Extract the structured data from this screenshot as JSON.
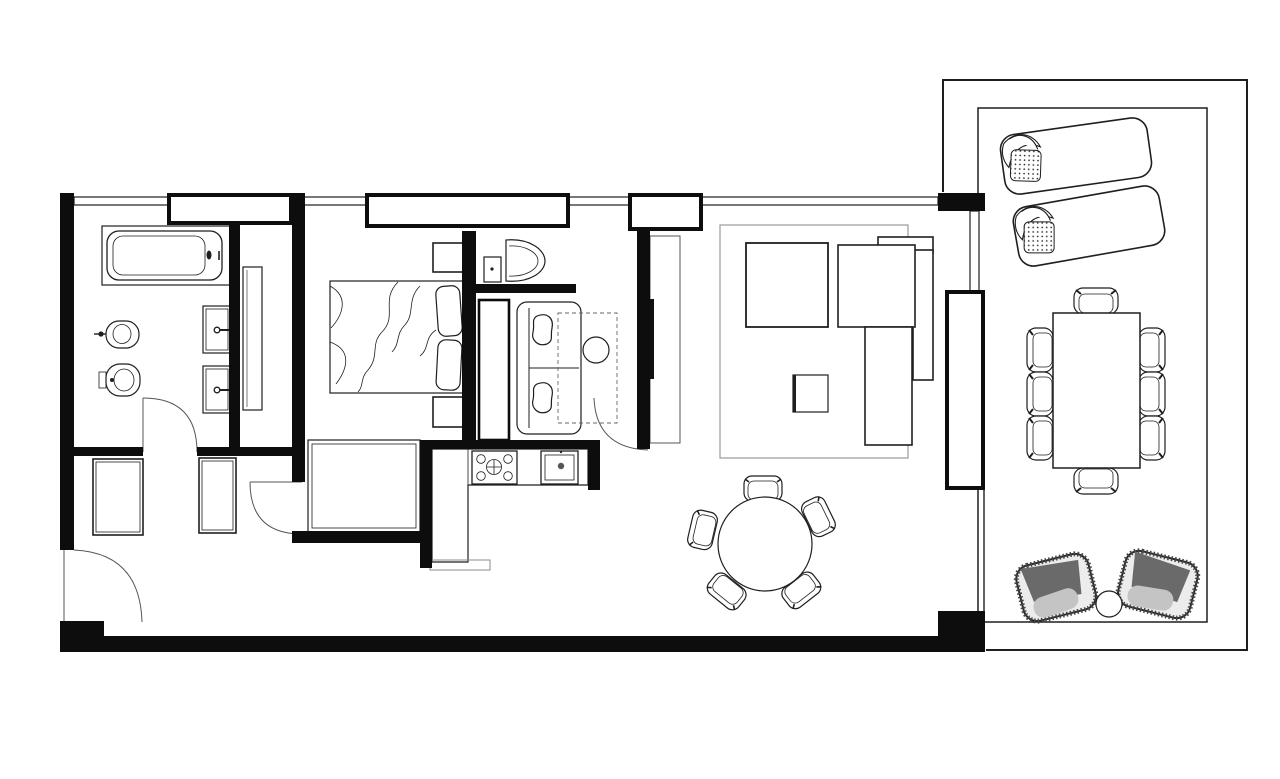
{
  "document": {
    "type": "architectural-floor-plan",
    "style": "black-and-white CAD line drawing",
    "description": "One-bedroom apartment floor plan with bathroom, entry hall, bedroom, TV nook, WC, kitchen, living-dining room and a large furnished terrace"
  },
  "colors": {
    "background": "#ffffff",
    "line": "#1f1f1f",
    "wall_fill": "#0d0d0d",
    "rug_outline": "#999999",
    "tv_fill": "#111111",
    "cabinet_outline": "#555555",
    "armchair_dark": "#6a6a6a",
    "armchair_light": "#c4c4c4"
  },
  "rooms": [
    {
      "name": "bathroom",
      "furniture": [
        "bathtub",
        "bidet",
        "toilet",
        "vanity-sink-1",
        "vanity-sink-2",
        "service-shaft"
      ]
    },
    {
      "name": "entry-hall",
      "furniture": [
        "closet-left",
        "closet-right"
      ],
      "doors": [
        "entrance-door",
        "bathroom-door",
        "bedroom-door"
      ]
    },
    {
      "name": "bedroom",
      "furniture": [
        "double-bed",
        "pillow",
        "pillow",
        "nightstand-top",
        "nightstand-bottom",
        "wardrobe"
      ]
    },
    {
      "name": "wc",
      "furniture": [
        "washbasin",
        "boiler-box"
      ]
    },
    {
      "name": "tv-nook",
      "furniture": [
        "tall-cabinet",
        "loveseat-sofa",
        "throw-pillow",
        "throw-pillow",
        "round-side-table",
        "overhead-dashed-unit",
        "tv-partition-wall",
        "tv",
        "tv-cabinet"
      ]
    },
    {
      "name": "kitchen",
      "furniture": [
        "l-shaped-counter",
        "cooktop-4-burner",
        "kitchen-sink",
        "counter-step"
      ]
    },
    {
      "name": "living-room",
      "furniture": [
        "rug",
        "square-lounge-seat",
        "sectional-sofa",
        "coffee-table"
      ]
    },
    {
      "name": "dining-area",
      "furniture": [
        "round-dining-table",
        "dining-chair x5"
      ]
    },
    {
      "name": "terrace",
      "furniture": [
        "sun-lounger x2",
        "terrace-dining-table",
        "terrace-chair x8",
        "outdoor-armchair x2",
        "round-side-table"
      ]
    }
  ],
  "counts": {
    "dining_table_chairs": 5,
    "terrace_table_chairs": 8,
    "sun_loungers": 2,
    "terrace_armchairs": 2,
    "hall_closets": 2,
    "bathroom_vanities": 2,
    "window_bands_top": 1,
    "doors_with_swing_arcs": 4
  }
}
